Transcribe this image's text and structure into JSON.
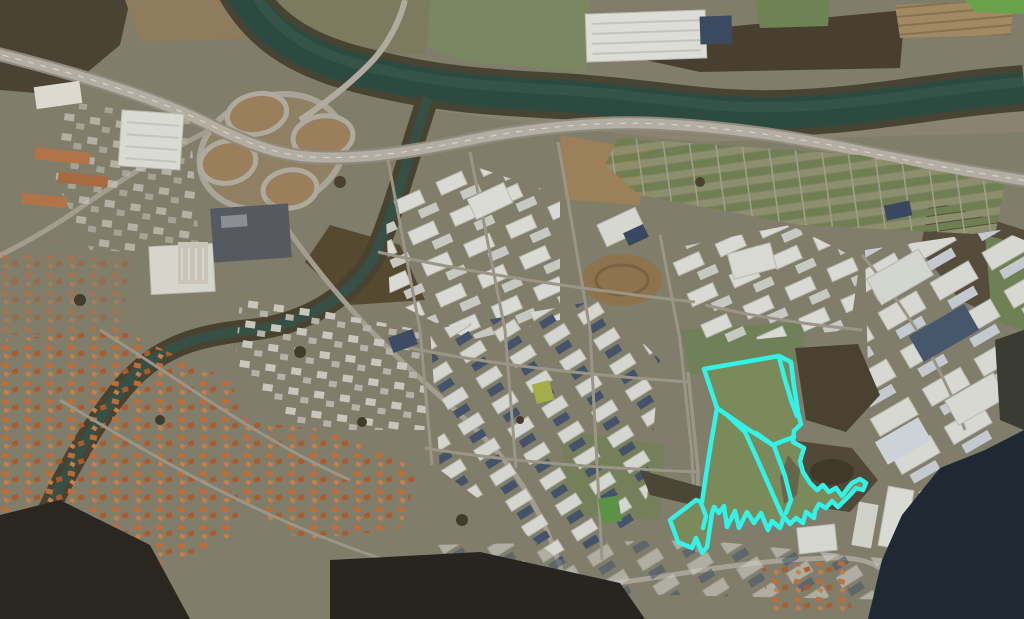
{
  "view": {
    "type": "satellite-imagery",
    "description": "Aerial photo: river with motorway interchange top-left, industrial estate centre-right, orange-roofed town lower-left, dark wooded hill bottom-right; cadastral parcels highlighted with cyan outline",
    "width": 1024,
    "height": 619
  },
  "parcel_overlay": {
    "label": "highlighted-parcels",
    "color": "#35f2e6",
    "stroke_width": 4.5,
    "outer_polygon": [
      [
        704,
        369
      ],
      [
        779,
        356
      ],
      [
        791,
        362
      ],
      [
        794,
        386
      ],
      [
        798,
        412
      ],
      [
        801,
        424
      ],
      [
        794,
        431
      ],
      [
        793,
        442
      ],
      [
        804,
        448
      ],
      [
        800,
        461
      ],
      [
        803,
        472
      ],
      [
        810,
        483
      ],
      [
        817,
        490
      ],
      [
        823,
        485
      ],
      [
        829,
        492
      ],
      [
        836,
        488
      ],
      [
        842,
        496
      ],
      [
        847,
        489
      ],
      [
        852,
        483
      ],
      [
        860,
        479
      ],
      [
        866,
        483
      ],
      [
        863,
        490
      ],
      [
        856,
        488
      ],
      [
        851,
        494
      ],
      [
        844,
        501
      ],
      [
        838,
        507
      ],
      [
        832,
        501
      ],
      [
        826,
        508
      ],
      [
        819,
        504
      ],
      [
        815,
        511
      ],
      [
        814,
        518
      ],
      [
        806,
        512
      ],
      [
        803,
        523
      ],
      [
        796,
        518
      ],
      [
        790,
        524
      ],
      [
        784,
        517
      ],
      [
        780,
        528
      ],
      [
        772,
        521
      ],
      [
        768,
        530
      ],
      [
        761,
        513
      ],
      [
        754,
        523
      ],
      [
        747,
        512
      ],
      [
        739,
        528
      ],
      [
        735,
        511
      ],
      [
        727,
        527
      ],
      [
        724,
        506
      ],
      [
        719,
        513
      ],
      [
        714,
        507
      ],
      [
        712,
        513
      ],
      [
        710,
        527
      ],
      [
        707,
        547
      ],
      [
        702,
        553
      ],
      [
        699,
        545
      ],
      [
        696,
        538
      ],
      [
        692,
        548
      ],
      [
        678,
        542
      ],
      [
        670,
        520
      ],
      [
        696,
        500
      ],
      [
        702,
        502
      ],
      [
        706,
        475
      ],
      [
        711,
        443
      ],
      [
        717,
        408
      ]
    ],
    "inner_lines": [
      [
        [
          717,
          408
        ],
        [
          746,
          428
        ],
        [
          773,
          445
        ],
        [
          783,
          441
        ],
        [
          794,
          437
        ]
      ],
      [
        [
          727,
          415
        ],
        [
          745,
          432
        ],
        [
          760,
          465
        ],
        [
          774,
          497
        ],
        [
          782,
          515
        ]
      ],
      [
        [
          756,
          433
        ],
        [
          774,
          446
        ],
        [
          785,
          476
        ],
        [
          791,
          500
        ],
        [
          786,
          513
        ]
      ],
      [
        [
          779,
          357
        ],
        [
          785,
          380
        ],
        [
          792,
          403
        ],
        [
          797,
          416
        ]
      ],
      [
        [
          701,
          503
        ],
        [
          706,
          516
        ],
        [
          703,
          528
        ]
      ]
    ]
  },
  "palette": {
    "river": "#2d4a41",
    "field": "#75845a",
    "woods": "#463e2f",
    "road": "#b2ada0",
    "town_roof": "#bf6c39",
    "industrial_roof": "#d7d8d1",
    "dark_hill": "#202834"
  }
}
